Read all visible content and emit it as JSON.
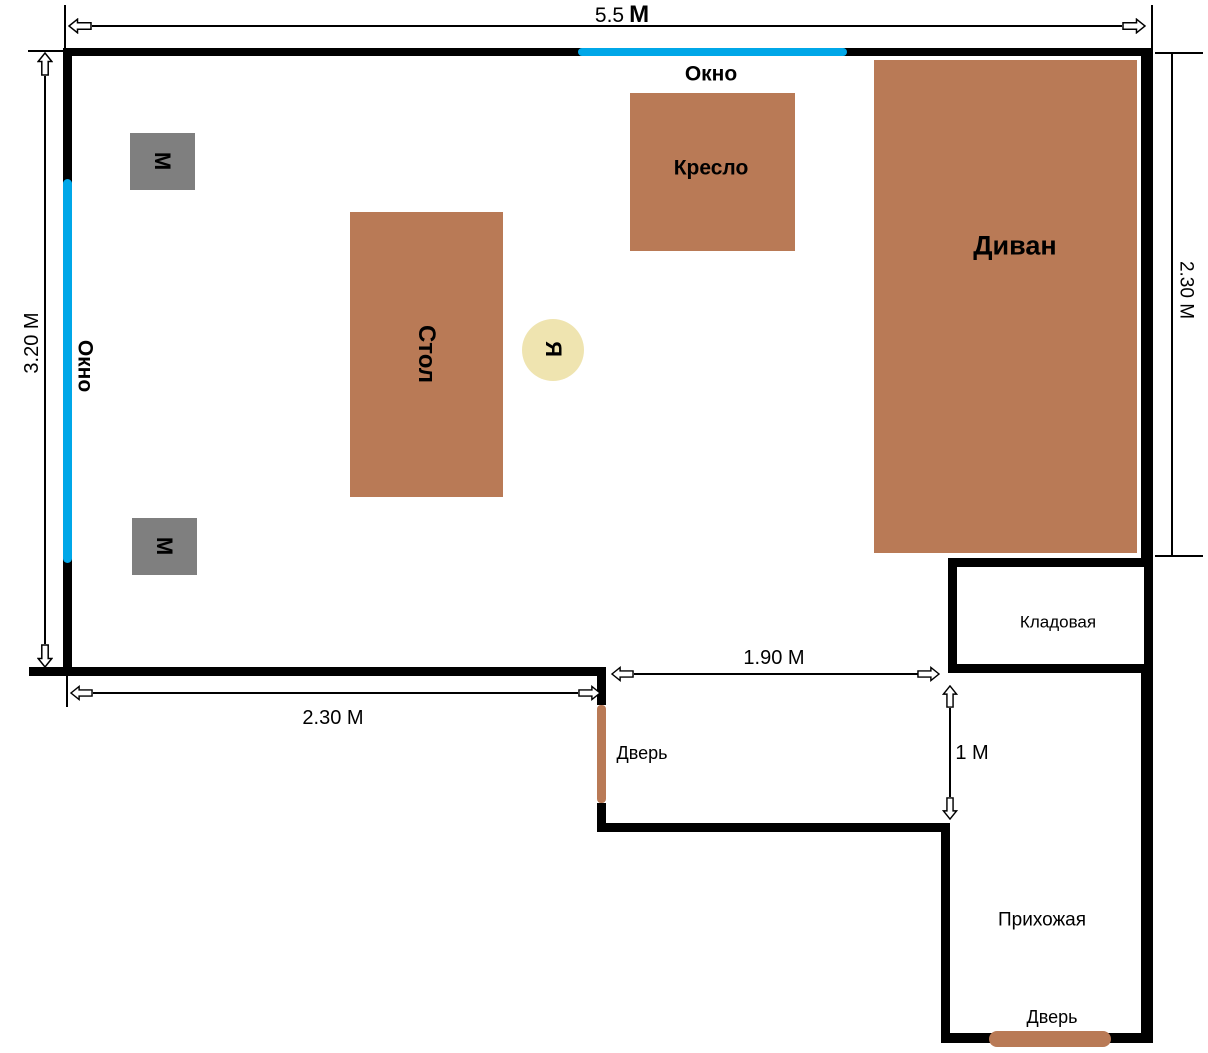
{
  "dimensions": {
    "top_value": "5.5",
    "top_unit": "М",
    "left_wall": "3.20 М",
    "bottom_wall": "2.30 М",
    "opening": "1.90 М",
    "passage": "1 М",
    "sofa_side": "2.30 М"
  },
  "furniture": {
    "sofa": "Диван",
    "armchair": "Кресло",
    "table": "Стол",
    "person": "Я",
    "speaker": "М"
  },
  "windows": {
    "top": "Окно",
    "left": "Окно"
  },
  "doors": {
    "middle": "Дверь",
    "bottom": "Дверь"
  },
  "rooms": {
    "storage": "Кладовая",
    "hallway": "Прихожая"
  },
  "colors": {
    "wall": "#000000",
    "window": "#00a7e8",
    "furniture": "#b97a56",
    "door": "#b97a56",
    "speaker": "#7f7f7f",
    "person": "#efe4b0"
  }
}
